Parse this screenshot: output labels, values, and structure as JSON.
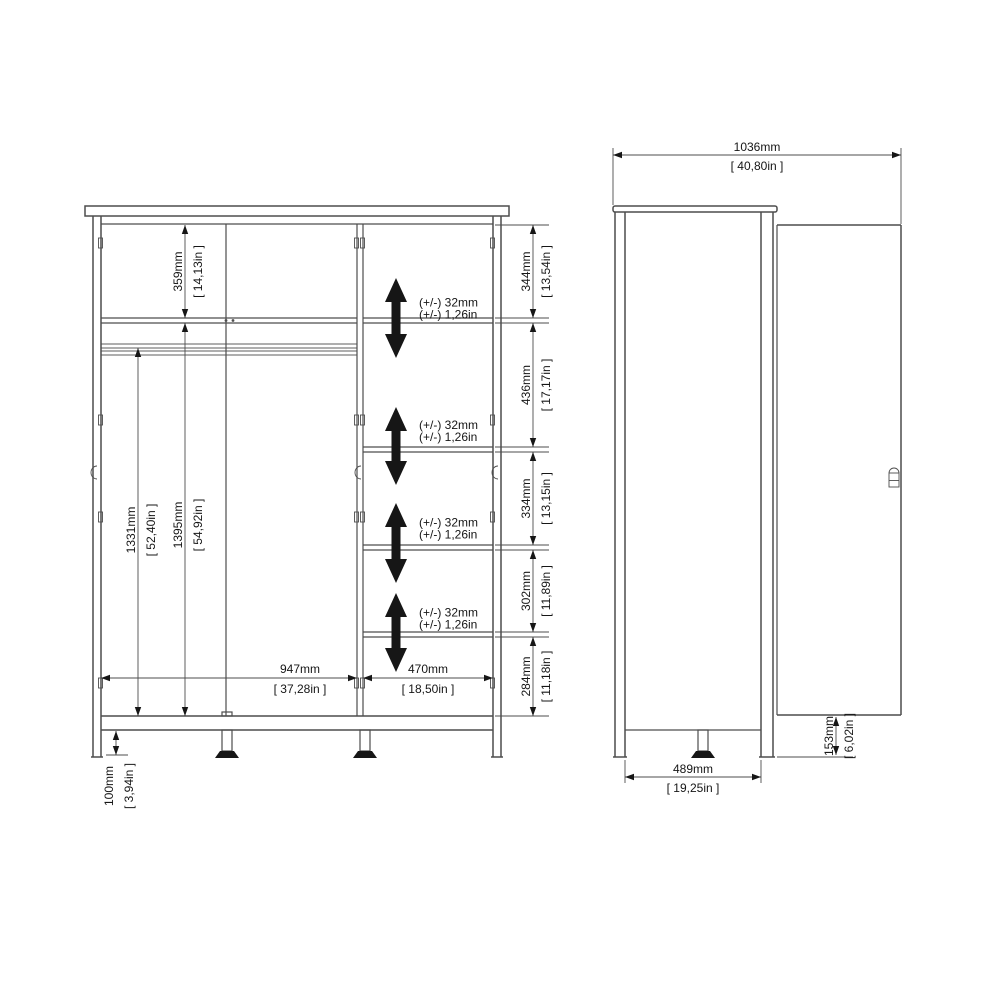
{
  "diagram_title": "wardrobe-dimension-drawing",
  "front_view": {
    "dims": {
      "top_section": {
        "mm": "359mm",
        "in": "[ 14,13in ]"
      },
      "rail_height": {
        "mm": "1331mm",
        "in": "[ 52,40in ]"
      },
      "left_height": {
        "mm": "1395mm",
        "in": "[ 54,92in ]"
      },
      "left_width": {
        "mm": "947mm",
        "in": "[ 37,28in ]"
      },
      "column_width": {
        "mm": "470mm",
        "in": "[ 18,50in ]"
      },
      "leg_height": {
        "mm": "100mm",
        "in": "[ 3,94in ]"
      },
      "shelf_gaps": [
        {
          "mm": "344mm",
          "in": "[ 13,54in ]"
        },
        {
          "mm": "436mm",
          "in": "[ 17,17in ]"
        },
        {
          "mm": "334mm",
          "in": "[ 13,15in ]"
        },
        {
          "mm": "302mm",
          "in": "[ 11,89in ]"
        },
        {
          "mm": "284mm",
          "in": "[ 11,18in ]"
        }
      ],
      "shelf_adjust": {
        "mm": "(+/-) 32mm",
        "in": "(+/-) 1,26in"
      }
    }
  },
  "side_view": {
    "dims": {
      "total_depth": {
        "mm": "1036mm",
        "in": "[ 40,80in ]"
      },
      "body_depth": {
        "mm": "489mm",
        "in": "[ 19,25in ]"
      },
      "door_floor_gap": {
        "mm": "153mm",
        "in": "[ 6,02in ]"
      }
    }
  },
  "colors": {
    "line": "#4d4d4d",
    "text": "#161616",
    "background": "#ffffff"
  }
}
